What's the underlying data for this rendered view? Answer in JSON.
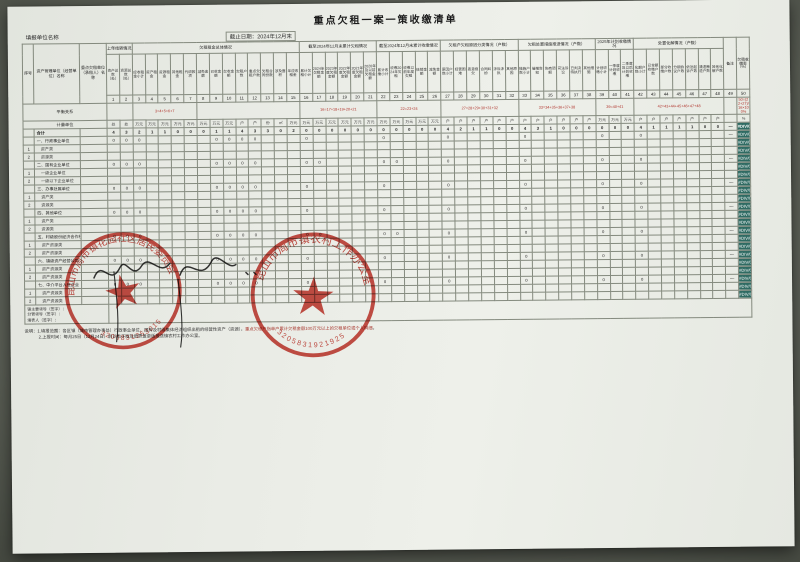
{
  "page": {
    "title": "重点欠租一案一策收缴清单",
    "form_unit_label": "填报单位名称",
    "date_label": "截止日期：2024年12月末"
  },
  "table": {
    "fixed_columns": [
      "序号",
      "资产管理单位（经营单位）名称",
      "重点欠租单位（承租人）名称"
    ],
    "groups": [
      {
        "label": "上年结转情况",
        "span": 2
      },
      {
        "label": "欠租租金总体情况",
        "span": 13
      },
      {
        "label": "截至2024年12月末累计欠租情况",
        "span": 6
      },
      {
        "label": "截至2024年12月末累计收缴情况",
        "span": 5
      },
      {
        "label": "欠租户欠租原因分类情况（户数）",
        "span": 6
      },
      {
        "label": "欠租处置措施推进情况（户数）",
        "span": 6
      },
      {
        "label": "2025年计划收缴情况",
        "span": 3
      },
      {
        "label": "处置化解情况（户数）",
        "span": 7
      },
      {
        "label": "备注",
        "span": 1,
        "tall": true
      },
      {
        "label": "欠租收缴率（%）",
        "span": 1,
        "tall": true
      }
    ],
    "leaf_labels": [
      "资产总数（处）",
      "资源总数（处）",
      "应收租金小计",
      "资产租金",
      "资源租金",
      "其他租金",
      "代收款项",
      "减免金额",
      "已收金额",
      "欠收金额",
      "欠租户数",
      "重点欠租户数",
      "欠租合同份数",
      "涉及面积",
      "年应收租金",
      "累计欠租小计",
      "2024年欠租金额",
      "2023年度欠租金额",
      "2022年度欠租金额",
      "2021年度欠租金额",
      "2020年及以前欠租金额",
      "累计收缴小计",
      "收缴2024年欠租",
      "收缴以前年度欠租",
      "核销金额",
      "减免金额",
      "原因户数小计",
      "经营困难",
      "恶意拖欠",
      "合同纠纷",
      "涉诉涉执",
      "其他原因",
      "措施户数小计",
      "催缴告知",
      "协商调解",
      "司法诉讼",
      "已判决待执行",
      "其他措施",
      "计划收缴小计",
      "一季度计划收缴",
      "二季度及以后计划收缴",
      "化解户数小计",
      "已全额收缴户数",
      "部分收缴户数",
      "分期协议户数",
      "依法起诉户数",
      "清退腾退户数",
      "其他化解户数",
      "",
      ""
    ],
    "col_numbers": [
      "1",
      "2",
      "3",
      "4",
      "5",
      "6",
      "7",
      "8",
      "9",
      "10",
      "11",
      "12",
      "13",
      "14",
      "15",
      "16",
      "17",
      "18",
      "19",
      "20",
      "21",
      "22",
      "23",
      "24",
      "25",
      "26",
      "27",
      "28",
      "29",
      "30",
      "31",
      "32",
      "33",
      "34",
      "35",
      "36",
      "37",
      "38",
      "39",
      "40",
      "41",
      "42",
      "43",
      "44",
      "45",
      "46",
      "47",
      "48",
      "49",
      "50"
    ],
    "balance_row": {
      "label": "平衡关系",
      "spans": [
        {
          "span": 2,
          "text": ""
        },
        {
          "span": 5,
          "text": "3=4+5+6+7"
        },
        {
          "span": 8,
          "text": ""
        },
        {
          "span": 6,
          "text": "16=17+18+19+20+21"
        },
        {
          "span": 5,
          "text": "22=23+24"
        },
        {
          "span": 6,
          "text": "27=28+29+30+31+32"
        },
        {
          "span": 6,
          "text": "33=34+35+36+37+38"
        },
        {
          "span": 3,
          "text": "39=40+41"
        },
        {
          "span": 7,
          "text": "42=43+44+45+46+47+48"
        },
        {
          "span": 1,
          "text": ""
        },
        {
          "span": 1,
          "text": "50=(22+27)/16×100%"
        }
      ]
    },
    "unit_row": {
      "label": "计量单位",
      "units": [
        "处",
        "处",
        "万元",
        "万元",
        "万元",
        "万元",
        "万元",
        "万元",
        "万元",
        "万元",
        "户",
        "户",
        "份",
        "㎡",
        "万元",
        "万元",
        "万元",
        "万元",
        "万元",
        "万元",
        "万元",
        "万元",
        "万元",
        "万元",
        "万元",
        "万元",
        "户",
        "户",
        "户",
        "户",
        "户",
        "户",
        "户",
        "户",
        "户",
        "户",
        "户",
        "户",
        "万元",
        "万元",
        "万元",
        "户",
        "户",
        "户",
        "户",
        "户",
        "户",
        "户",
        "",
        "%"
      ]
    },
    "rows": [
      {
        "no": "",
        "label": "合计",
        "type": "total",
        "cells": {
          "1": "4",
          "2": "3",
          "3": "2",
          "4": "1",
          "5": "1",
          "6": "0",
          "7": "0",
          "8": "0",
          "9": "1",
          "10": "1",
          "11": "4",
          "12": "3",
          "13": "3",
          "14": "0",
          "15": "2",
          "16": "0",
          "17": "0",
          "18": "0",
          "19": "0",
          "20": "0",
          "21": "0",
          "22": "0",
          "23": "0",
          "24": "0",
          "25": "0",
          "26": "0",
          "27": "4",
          "28": "2",
          "29": "1",
          "30": "1",
          "31": "0",
          "32": "0",
          "33": "4",
          "34": "3",
          "35": "1",
          "36": "0",
          "37": "0",
          "38": "0",
          "39": "0",
          "40": "0",
          "41": "0",
          "42": "4",
          "43": "1",
          "44": "1",
          "45": "1",
          "46": "1",
          "47": "0",
          "48": "0",
          "49": "—",
          "50": "#DIV/0!"
        }
      },
      {
        "no": "",
        "label": "一、行政事业单位",
        "type": "cat",
        "cells": {
          "1": "0",
          "2": "0",
          "3": "0",
          "9": "0",
          "10": "0",
          "11": "0",
          "12": "0",
          "16": "0",
          "22": "0",
          "27": "0",
          "33": "0",
          "39": "0",
          "42": "0",
          "49": "—",
          "50": "#DIV/0!"
        }
      },
      {
        "no": "1",
        "label": "资产类",
        "type": "sub",
        "cells": {
          "50": "#DIV/0!"
        }
      },
      {
        "no": "2",
        "label": "资源类",
        "type": "sub",
        "cells": {
          "50": "#DIV/0!"
        }
      },
      {
        "no": "",
        "label": "二、国有企业单位",
        "type": "cat",
        "cells": {
          "1": "0",
          "2": "0",
          "3": "0",
          "9": "0",
          "10": "0",
          "11": "0",
          "12": "0",
          "16": "0",
          "17": "0",
          "22": "0",
          "23": "0",
          "27": "0",
          "33": "0",
          "39": "0",
          "42": "0",
          "49": "—",
          "50": "#DIV/0!"
        }
      },
      {
        "no": "1",
        "label": "一级企业单位",
        "type": "sub",
        "cells": {
          "50": "#DIV/0!"
        }
      },
      {
        "no": "2",
        "label": "一级以下企业单位",
        "type": "sub",
        "cells": {
          "50": "#DIV/0!"
        }
      },
      {
        "no": "",
        "label": "三、办事处属单位",
        "type": "cat",
        "cells": {
          "1": "0",
          "2": "0",
          "3": "0",
          "9": "0",
          "10": "0",
          "11": "0",
          "12": "0",
          "16": "0",
          "22": "0",
          "27": "0",
          "33": "0",
          "39": "0",
          "42": "0",
          "49": "—",
          "50": "#DIV/0!"
        }
      },
      {
        "no": "1",
        "label": "资产类",
        "type": "sub",
        "cells": {
          "50": "#DIV/0!"
        }
      },
      {
        "no": "2",
        "label": "资源类",
        "type": "sub",
        "cells": {
          "50": "#DIV/0!"
        }
      },
      {
        "no": "",
        "label": "四、其他单位",
        "type": "cat",
        "cells": {
          "1": "0",
          "2": "0",
          "3": "0",
          "9": "0",
          "10": "0",
          "11": "0",
          "12": "0",
          "16": "0",
          "22": "0",
          "27": "0",
          "33": "0",
          "39": "0",
          "42": "0",
          "49": "—",
          "50": "#DIV/0!"
        }
      },
      {
        "no": "1",
        "label": "资产类",
        "type": "sub",
        "cells": {
          "50": "#DIV/0!"
        }
      },
      {
        "no": "2",
        "label": "资源类",
        "type": "sub",
        "cells": {
          "50": "#DIV/0!"
        }
      },
      {
        "no": "",
        "label": "五、村级股份经济合作社",
        "type": "cat",
        "cells": {
          "1": "0",
          "2": "0",
          "3": "0",
          "9": "0",
          "10": "0",
          "11": "0",
          "12": "0",
          "16": "0",
          "17": "0",
          "22": "0",
          "23": "0",
          "27": "0",
          "33": "0",
          "39": "0",
          "42": "0",
          "49": "—",
          "50": "#DIV/0!"
        }
      },
      {
        "no": "1",
        "label": "资产资源类",
        "type": "sub",
        "cells": {
          "50": "#DIV/0!"
        }
      },
      {
        "no": "2",
        "label": "资产资源类",
        "type": "sub",
        "cells": {
          "50": "#DIV/0!"
        }
      },
      {
        "no": "",
        "label": "六、镇级资产经营公司",
        "type": "cat",
        "cells": {
          "1": "0",
          "2": "0",
          "3": "0",
          "9": "0",
          "10": "0",
          "11": "0",
          "12": "0",
          "16": "0",
          "22": "0",
          "27": "0",
          "33": "0",
          "39": "0",
          "42": "0",
          "49": "—",
          "50": "#DIV/0!"
        }
      },
      {
        "no": "1",
        "label": "资产资源类",
        "type": "sub",
        "cells": {
          "50": "#DIV/0!"
        }
      },
      {
        "no": "2",
        "label": "资产资源类",
        "type": "sub",
        "cells": {
          "50": "#DIV/0!"
        }
      },
      {
        "no": "",
        "label": "七、中介平台入驻企业",
        "type": "cat",
        "cells": {
          "1": "0",
          "2": "0",
          "3": "0",
          "9": "0",
          "10": "0",
          "11": "0",
          "12": "0",
          "16": "0",
          "22": "0",
          "27": "0",
          "33": "0",
          "39": "0",
          "42": "0",
          "49": "—",
          "50": "#DIV/0!"
        }
      },
      {
        "no": "1",
        "label": "资产资源类",
        "type": "sub",
        "cells": {
          "50": "#DIV/0!"
        }
      },
      {
        "no": "2",
        "label": "资产资源类",
        "type": "sub",
        "cells": {
          "50": "#DIV/0!"
        }
      }
    ],
    "sign_row": {
      "label_lines": [
        "镇主要领导（签字）：",
        "分管领导（签字）：",
        "填表人（签字）："
      ]
    },
    "error_value": "#DIV/0!",
    "dash": "—"
  },
  "notes": {
    "line1_a": "说明：1.填报范围：各区镇（城市管理办事处）行政事业单位、国有及村级集体经济组织出租的经营性资产（资源），",
    "line1_b": "重点欠租户指单户累计欠租金额100万元以上的欠租单位或个人明细",
    "line1_c": "。",
    "line2": "2.上报时间：每月25日（12月24日）前以电子版及纸质盖章版报送镇农村工作办公室。"
  },
  "stamps": [
    {
      "arc_text": "昆山市周市镇花园社区居民委员会",
      "number": "3205831253015"
    },
    {
      "arc_text": "昆山市周市镇农村工作办公室",
      "number": "3205831921925"
    }
  ],
  "colors": {
    "seal_red": "#c5372e",
    "error_cell_bg": "#2f6b63",
    "formula_red": "#b0322a",
    "paper": "#eaece6"
  }
}
